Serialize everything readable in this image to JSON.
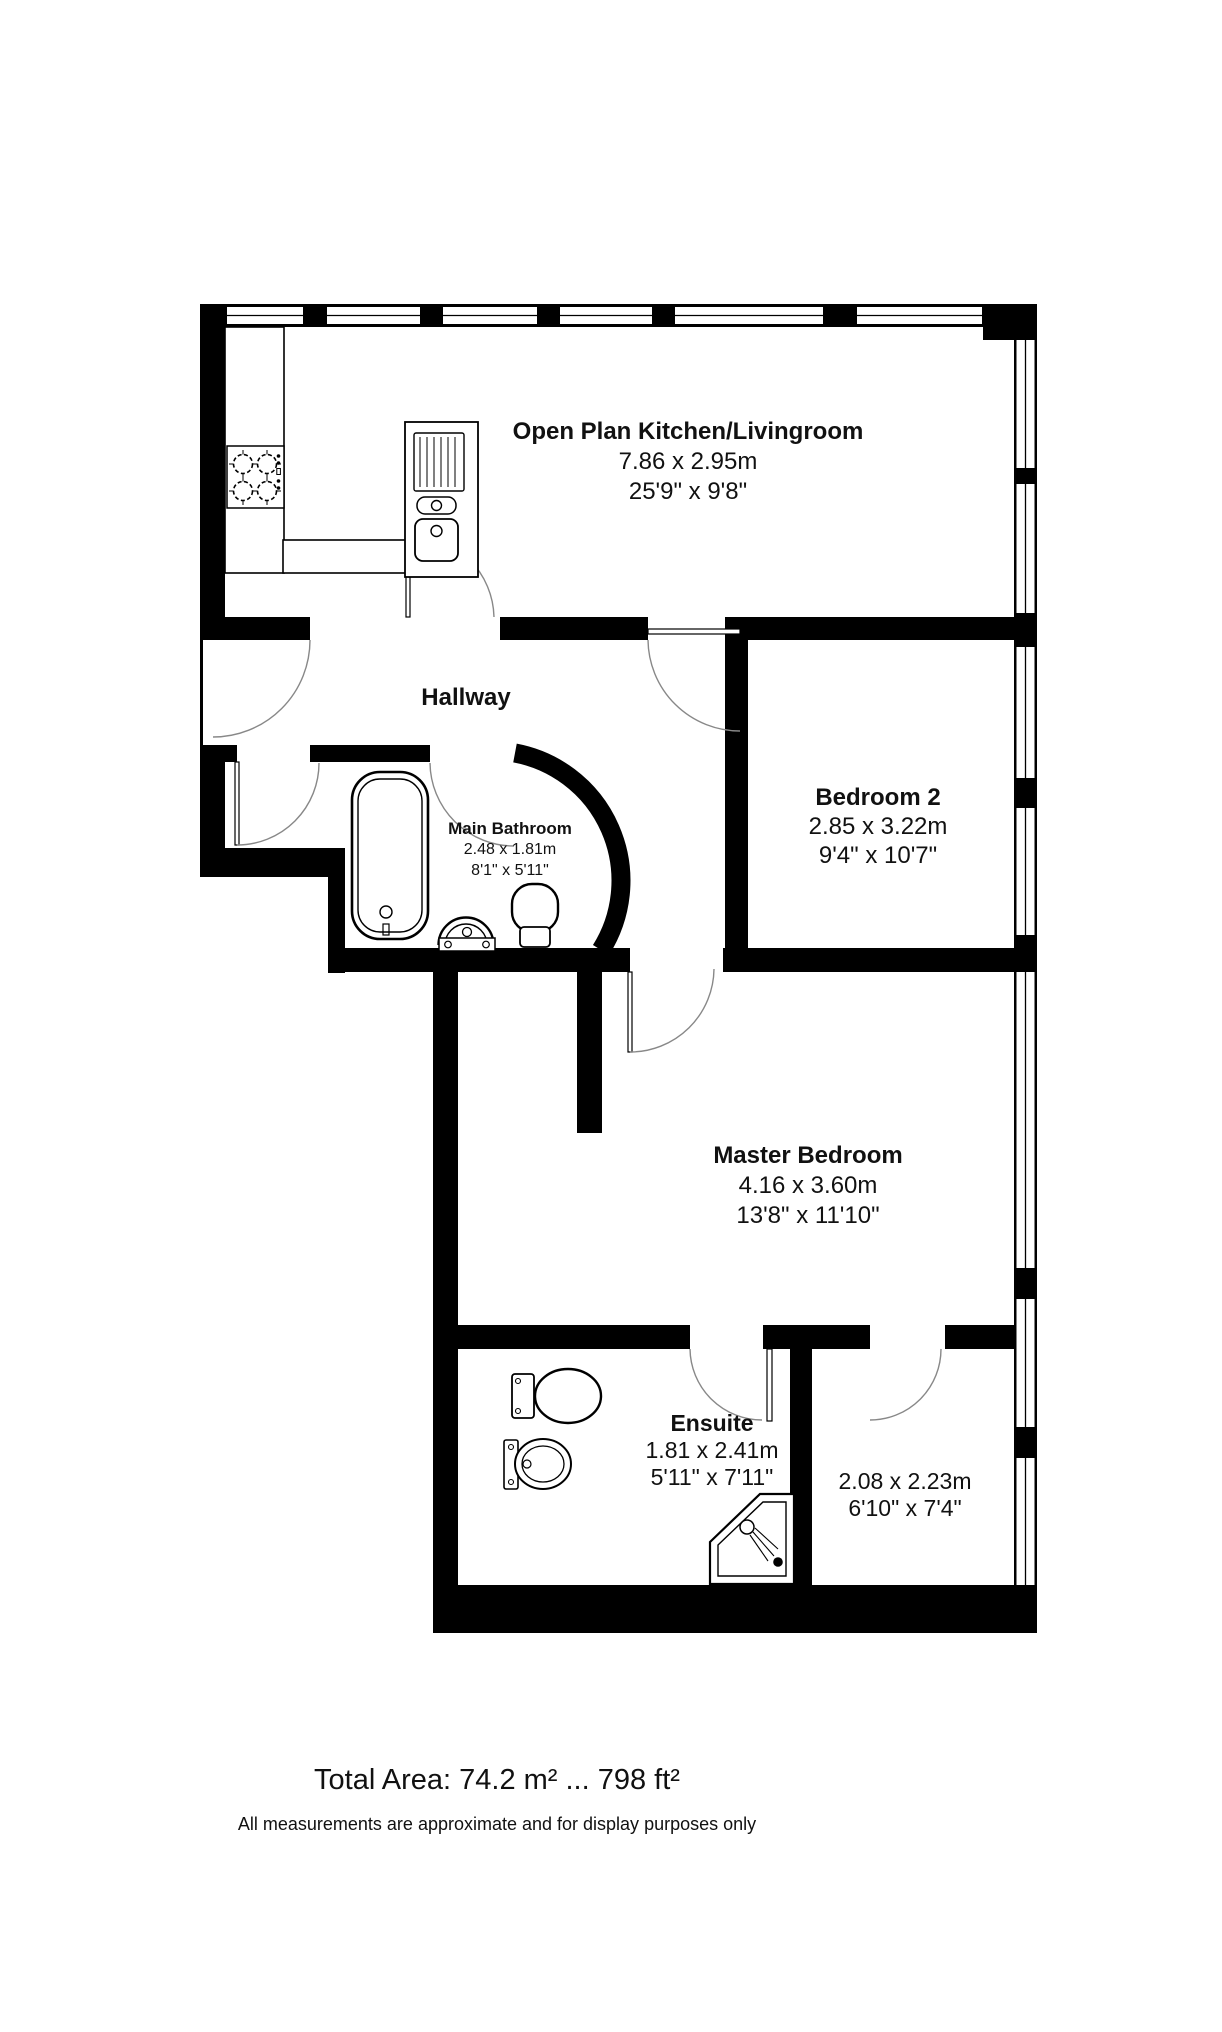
{
  "rooms": [
    {
      "name": "Open Plan Kitchen/Livingroom",
      "metric": "7.86 x 2.95m",
      "imperial": "25'9\" x 9'8\""
    },
    {
      "name": "Hallway"
    },
    {
      "name": "Main Bathroom",
      "metric": "2.48 x 1.81m",
      "imperial": "8'1\" x 5'11\""
    },
    {
      "name": "Bedroom 2",
      "metric": "2.85 x 3.22m",
      "imperial": "9'4\" x 10'7\""
    },
    {
      "name": "Master Bedroom",
      "metric": "4.16 x 3.60m",
      "imperial": "13'8\" x 11'10\""
    },
    {
      "name": "Ensuite",
      "metric": "1.81 x 2.41m",
      "imperial": "5'11\" x 7'11\""
    },
    {
      "name": "",
      "metric": "2.08 x 2.23m",
      "imperial": "6'10\" x 7'4\""
    }
  ],
  "footer": {
    "total_area": "Total Area: 74.2 m² ... 798 ft²",
    "disclaimer": "All measurements are approximate and for display purposes only"
  },
  "colors": {
    "wall": "#000000",
    "background": "#ffffff",
    "door_arc": "#888888",
    "text": "#111111"
  },
  "icons": {
    "stove-icon": "four-burner hob outline",
    "kitchen-sink-icon": "drainer with two basins",
    "bathtub-icon": "rounded bathtub outline",
    "basin-icon": "semicircular wash basin",
    "toilet-icon": "toilet with cistern",
    "pedestal-sink-icon": "oval pedestal sink",
    "shower-icon": "corner shower tray with head and drain",
    "window": "double-line window in wall",
    "door-swing-arc": "quarter-circle door swing"
  }
}
